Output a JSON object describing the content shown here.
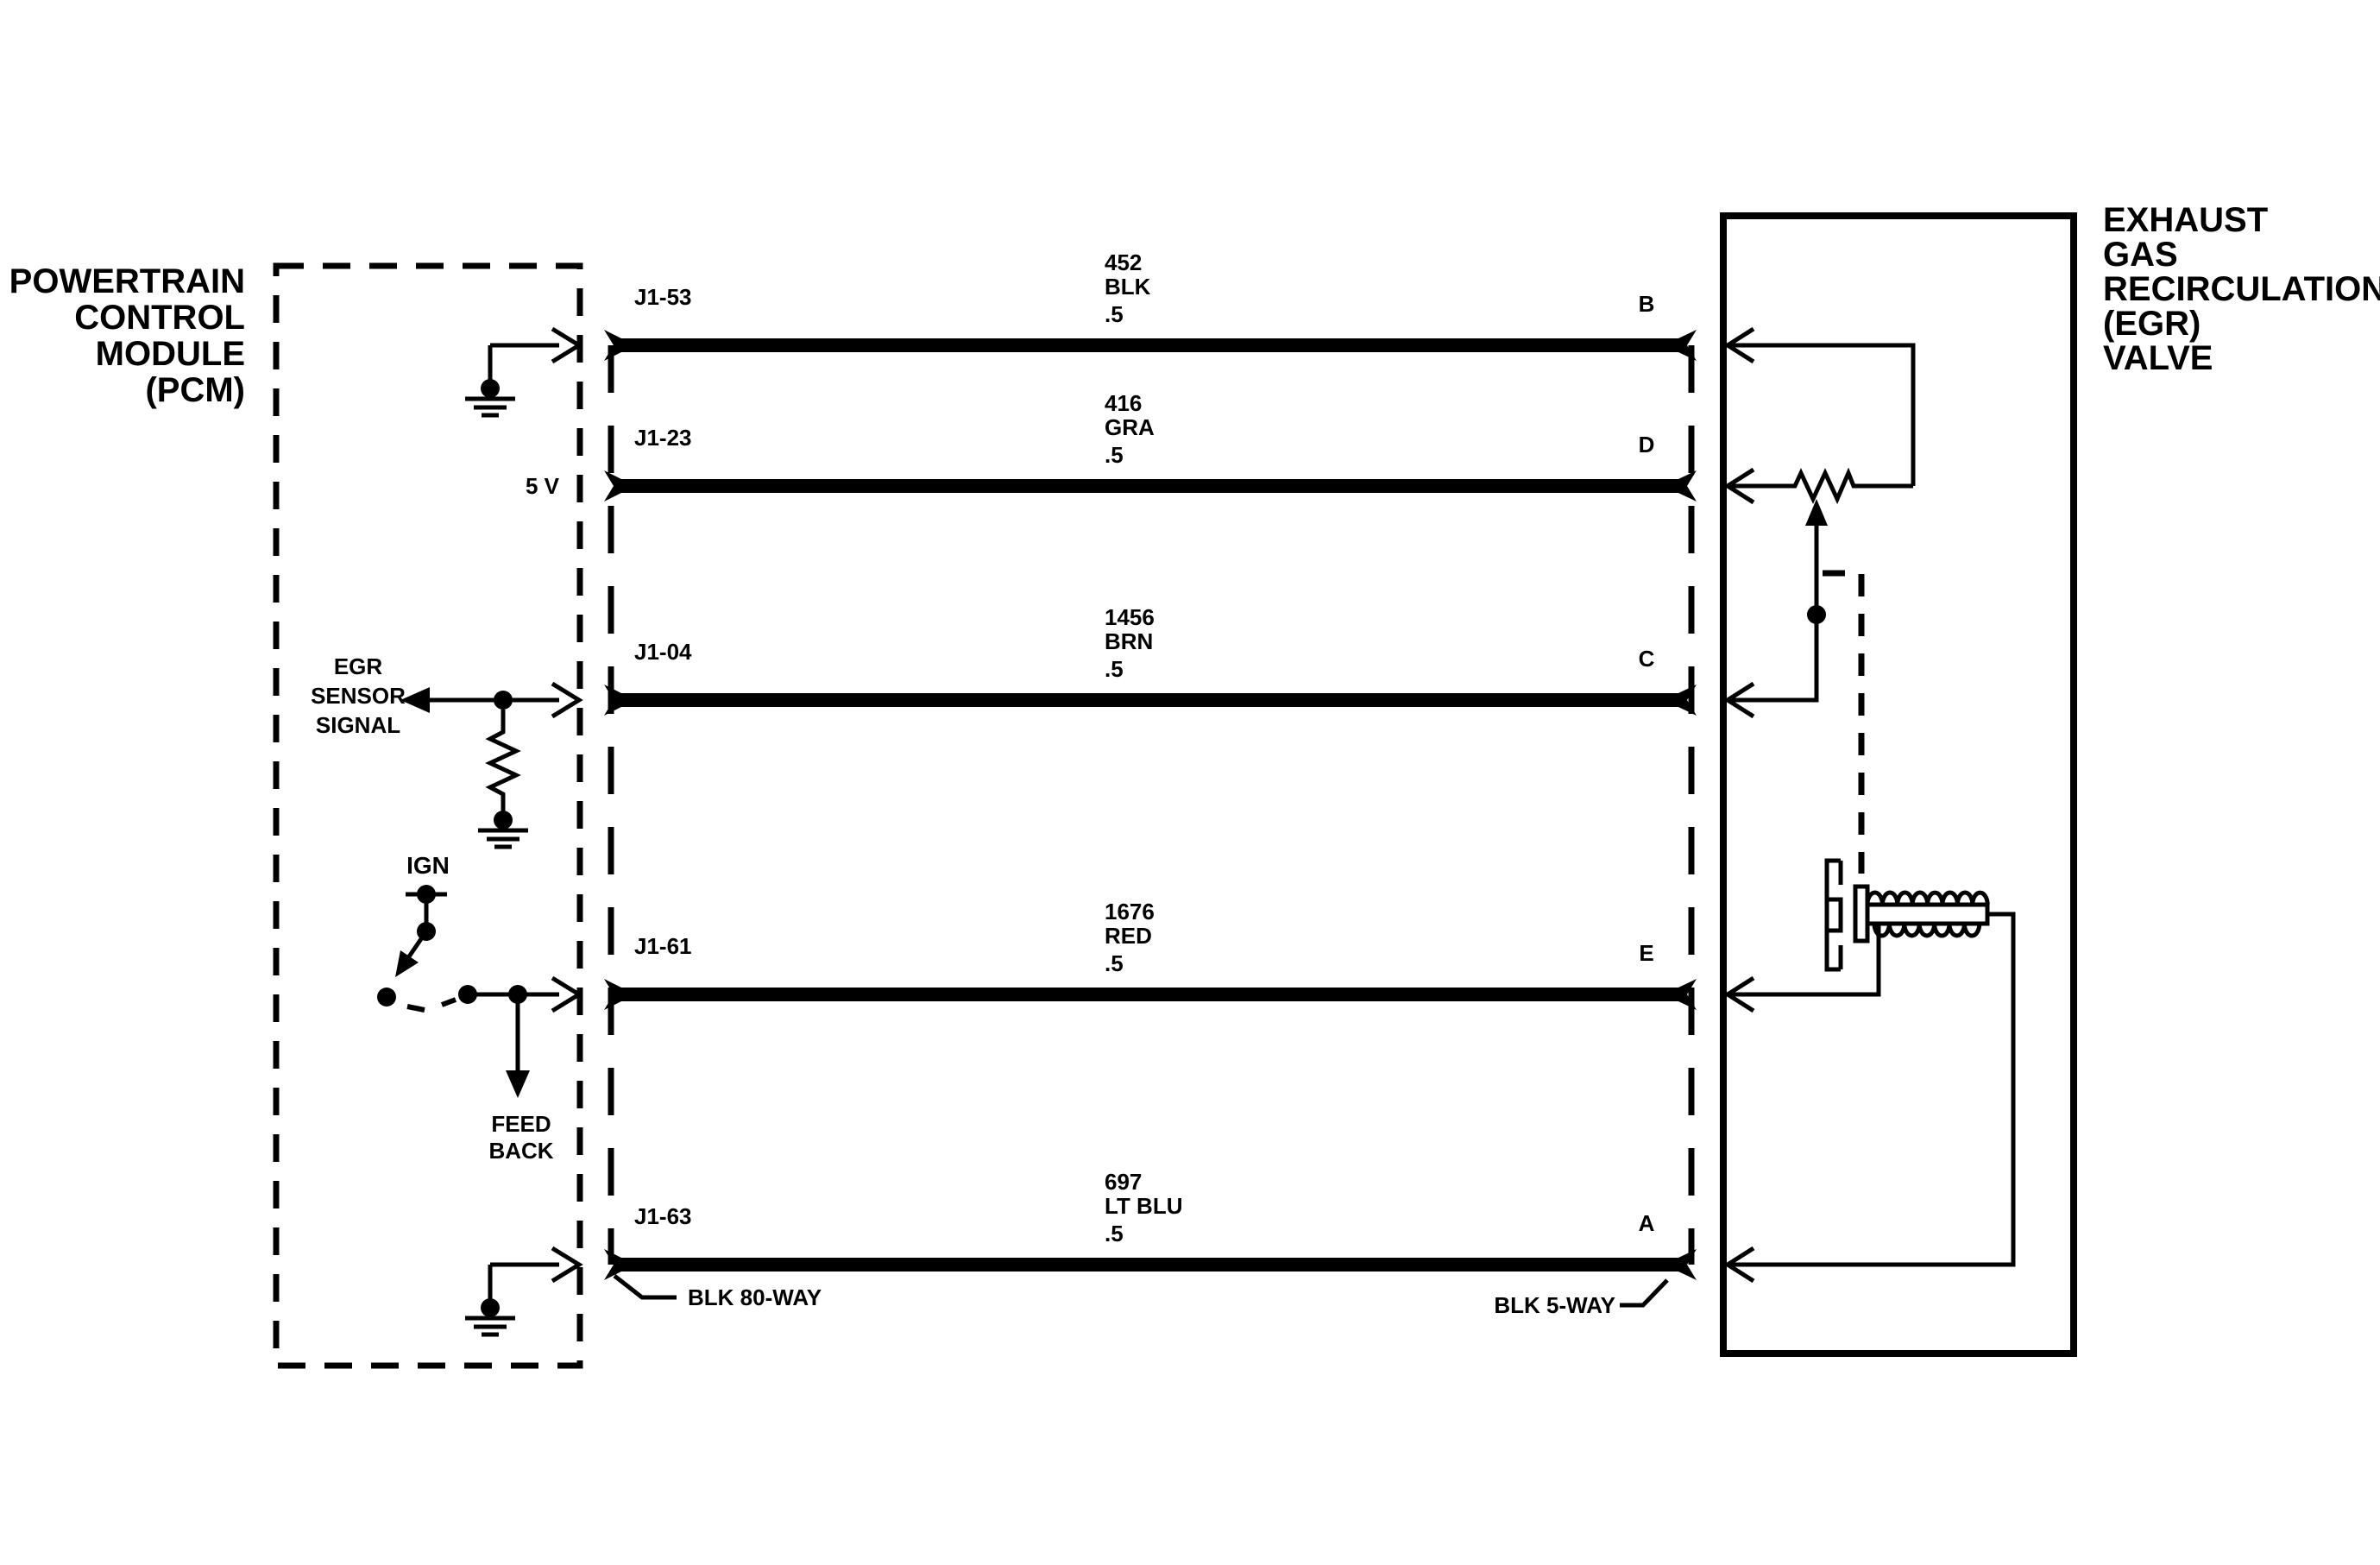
{
  "pcm": {
    "title_lines": [
      "POWERTRAIN",
      "CONTROL",
      "MODULE",
      "(PCM)"
    ],
    "five_volt_label": "5 V",
    "egr_sensor_signal_lines": [
      "EGR",
      "SENSOR",
      "SIGNAL"
    ],
    "ignition_label": "IGN",
    "feedback_lines": [
      "FEED",
      "BACK"
    ],
    "connector_label": "BLK 80-WAY"
  },
  "egr_valve": {
    "title_lines": [
      "EXHAUST",
      "GAS",
      "RECIRCULATION",
      "(EGR)",
      "VALVE"
    ],
    "connector_label": "BLK 5-WAY"
  },
  "wires": [
    {
      "pcm_pin": "J1-53",
      "circuit_number": "452",
      "wire_color": "BLK",
      "wire_gauge": ".5",
      "egr_pin": "B"
    },
    {
      "pcm_pin": "J1-23",
      "circuit_number": "416",
      "wire_color": "GRA",
      "wire_gauge": ".5",
      "egr_pin": "D"
    },
    {
      "pcm_pin": "J1-04",
      "circuit_number": "1456",
      "wire_color": "BRN",
      "wire_gauge": ".5",
      "egr_pin": "C"
    },
    {
      "pcm_pin": "J1-61",
      "circuit_number": "1676",
      "wire_color": "RED",
      "wire_gauge": ".5",
      "egr_pin": "E"
    },
    {
      "pcm_pin": "J1-63",
      "circuit_number": "697",
      "wire_color": "LT BLU",
      "wire_gauge": ".5",
      "egr_pin": "A"
    }
  ],
  "colors": {
    "ink": "#000000",
    "paper": "#ffffff"
  }
}
